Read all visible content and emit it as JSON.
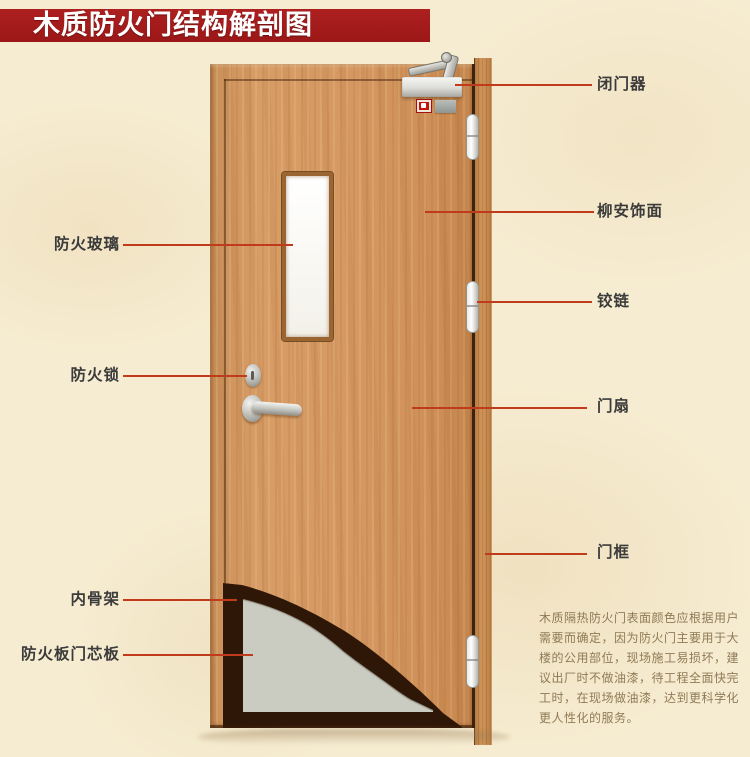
{
  "title": "木质防火门结构解剖图",
  "colors": {
    "banner": "#9c1717",
    "leader_line": "#c03a1c",
    "wood_leaf": "#d59862",
    "wood_frame": "#c08148",
    "core_board": "#caccc2",
    "inner_skeleton": "#2f1708",
    "background": "#f6ecd1",
    "alarm_indicator": "#c41410"
  },
  "labels": {
    "left": [
      {
        "text": "防火玻璃"
      },
      {
        "text": "防火锁"
      },
      {
        "text": "内骨架"
      },
      {
        "text": "防火板门芯板"
      }
    ],
    "right": [
      {
        "text": "闭门器"
      },
      {
        "text": "柳安饰面"
      },
      {
        "text": "铰链"
      },
      {
        "text": "门扇"
      },
      {
        "text": "门框"
      }
    ]
  },
  "description": {
    "lines": [
      "木质隔热防火门表面颜色应根据用户",
      "需要而确定，因为防火门主要用于大",
      "楼的公用部位，现场施工易损坏，建",
      "议出厂时不做油漆，待工程全面快完",
      "工时，在现场做油漆，达到更科学化",
      "更人性化的服务。"
    ]
  }
}
